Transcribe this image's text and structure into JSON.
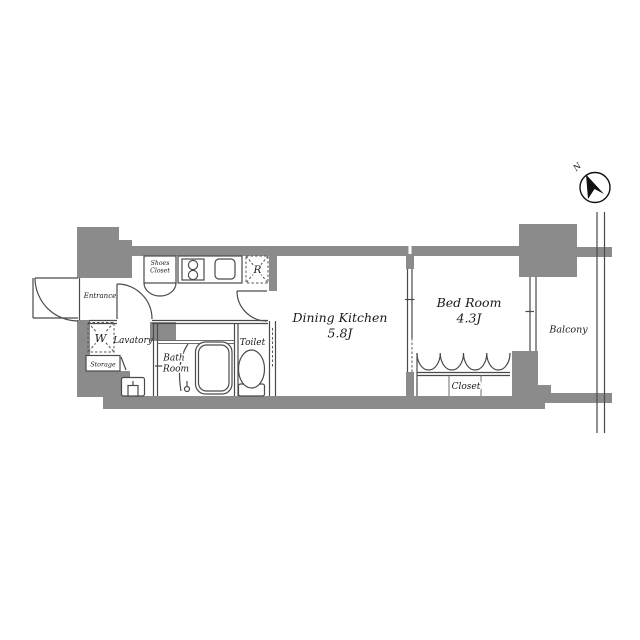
{
  "floorplan": {
    "compass": {
      "north": "N"
    },
    "labels": {
      "entrance": "Entrance",
      "shoes_closet": [
        "Shoes",
        "Closet"
      ],
      "washing_machine": "W",
      "lavatory": "Lavatory",
      "storage": "Storage",
      "bath_room": [
        "Bath",
        "Room"
      ],
      "toilet": "Toilet",
      "refrigerator": "R",
      "dining_kitchen": "Dining Kitchen",
      "dining_kitchen_size": "5.8J",
      "bed_room": "Bed Room",
      "bed_room_size": "4.3J",
      "closet": "Closet",
      "balcony": "Balcony"
    },
    "colors": {
      "wall": "#8b8b8b",
      "line": "#4a4a4a",
      "text": "#1a1a1a",
      "background": "#ffffff"
    }
  }
}
